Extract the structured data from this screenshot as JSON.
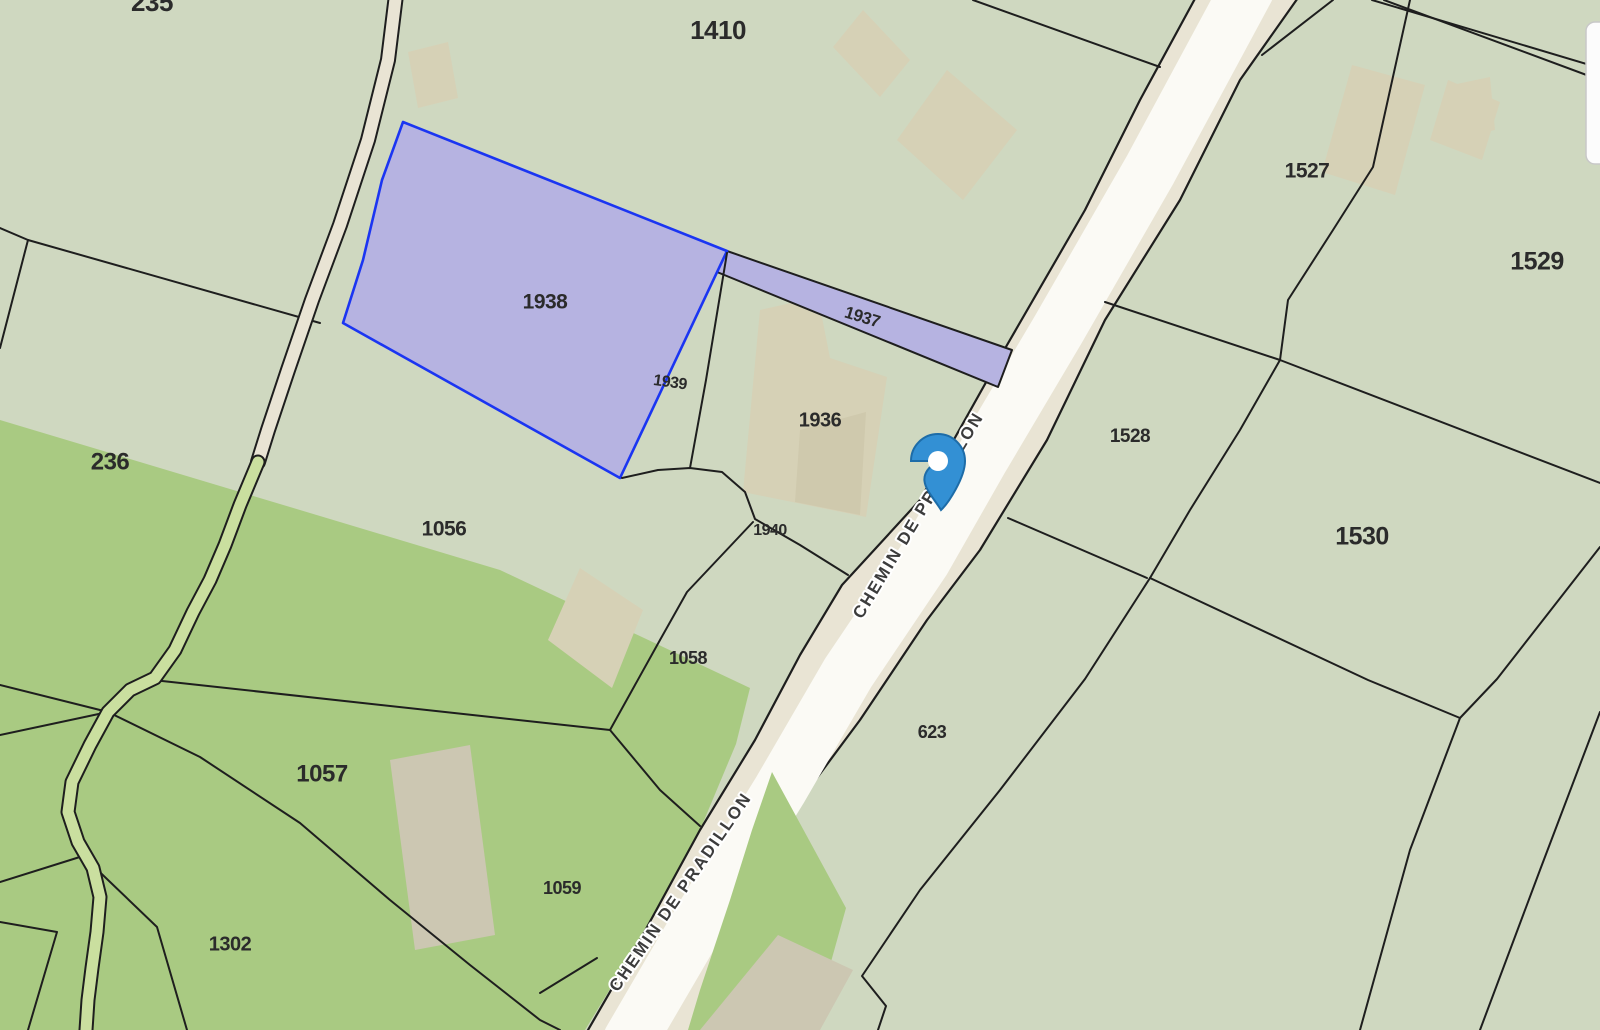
{
  "app": {
    "title": "Cadastral parcel map"
  },
  "map": {
    "width": 1600,
    "height": 1030,
    "colors": {
      "base_green": "#cfd8c0",
      "meadow_green": "#a9ca82",
      "stream_green": "#cadf9f",
      "road_beige": "#e9e4d4",
      "road_core_white": "#fbfaf5",
      "building_beige": "#d6d1b6",
      "building_dark": "#cfc9ad",
      "building_gray": "#ccc7b2",
      "selection_purple": "#b6b3e1",
      "selection_blue": "#1b35f2",
      "boundary_black": "#1e1e1e",
      "label_color": "#2b2b2b",
      "road_label_color": "#3c3c3c",
      "pin_blue": "#3390d4",
      "pin_blue_dark": "#1d6ca8",
      "panel_white": "#fcfcfc"
    },
    "landcover": {
      "meadow_main": "0,420 500,570 750,688 736,744 700,830 640,940 585,1030 0,1030",
      "meadow_road_east": "772,772 846,908 812,1030 688,1030 700,990 730,900 752,830"
    },
    "road": {
      "name": "CHEMIN DE PRADILLON",
      "fill": "1197,-5 1140,100 1085,210 1003,352 920,500 842,585 800,655 755,740 700,830 640,940 588,1030 690,1030 722,955 760,870 802,798 860,720 927,620 980,550 1047,440 1105,320 1180,200 1240,80 1300,-5",
      "left_edge": "1197,-5 1140,100 1085,210 1003,352 920,500 842,585 800,655 755,740 700,830 640,940 588,1030",
      "right_edge": "1300,-5 1240,80 1180,200 1105,320 1047,440 980,550 927,620 860,720 802,798 760,870 722,955 690,1030",
      "core": "1247,-10 1150,170 1058,330 981,460 924,560 848,673 780,790 700,920 630,1040",
      "core_width": 54,
      "labels": [
        {
          "x": 923,
          "y": 518,
          "rot": -59,
          "size": 17
        },
        {
          "x": 685,
          "y": 895,
          "rot": -55.5,
          "size": 17
        }
      ]
    },
    "path_track": {
      "points": "396,-5 388,60 368,140 340,225 312,300 288,370 268,430 258,462"
    },
    "stream": {
      "points": "258,462 240,505 225,545 210,580 193,612 175,650 155,678 130,690 108,712 90,745 72,782 68,812 78,842 93,868 100,897 97,932 92,968 88,1000 86,1030"
    },
    "selected_parcels": [
      {
        "id": "1937",
        "points": "727,251 1012,350 998,387 717,272",
        "outline": "black"
      },
      {
        "id": "1938",
        "points": "403,122 727,251 620,478 343,323 363,260 382,180",
        "outline": "blue"
      }
    ],
    "boundary_lines": [
      {
        "name": "parcel-235-south",
        "points": "0,228 28,240 320,323"
      },
      {
        "name": "parcel-235-west",
        "points": "28,240 0,348"
      },
      {
        "name": "parcel-1410-north",
        "points": "973,0 1160,67"
      },
      {
        "name": "parcel-1939-east",
        "points": "727,253 706,380 690,468"
      },
      {
        "name": "parcel-1940-north",
        "points": "622,478 658,470 690,468 722,472 745,492 755,519 800,545 848,575"
      },
      {
        "name": "parcel-1940-west",
        "points": "753,522 687,592 660,640 610,730"
      },
      {
        "name": "parcel-1056-south",
        "points": "153,680 500,718 610,730"
      },
      {
        "name": "parcel-1059-north",
        "points": "610,730 660,790 700,826"
      },
      {
        "name": "parcel-1302-north",
        "points": "108,712 200,757 300,823 390,900 470,965 540,1020 560,1030"
      },
      {
        "name": "edge-parcel-a",
        "points": "0,685 108,712"
      },
      {
        "name": "edge-parcel-b",
        "points": "0,735 108,712"
      },
      {
        "name": "edge-parcel-c",
        "points": "0,882 83,856"
      },
      {
        "name": "edge-parcel-d",
        "points": "0,922 57,932 28,1030"
      },
      {
        "name": "edge-parcel-e",
        "points": "83,856 157,927 187,1030"
      },
      {
        "name": "parcel-1059-corner",
        "points": "540,993 597,958"
      },
      {
        "name": "parcel-1528-north",
        "points": "1333,0 1262,55"
      },
      {
        "name": "parcel-1527-east",
        "points": "1410,0 1373,167 1333,230 1288,300 1280,360 1240,430 1190,510 1150,578"
      },
      {
        "name": "parcel-623-east",
        "points": "1150,578 1085,679 1000,790 920,890 862,976 886,1006 878,1030"
      },
      {
        "name": "parcel-1530-north",
        "points": "1105,302 1280,360 1600,483"
      },
      {
        "name": "parcel-1528-south",
        "points": "1008,518 1147,578"
      },
      {
        "name": "parcel-1530-west",
        "points": "1150,578 1368,680 1460,718"
      },
      {
        "name": "parcel-1530-east-curve",
        "points": "1600,547 1497,679 1460,718 1410,850 1360,1030"
      },
      {
        "name": "parcel-se-curve",
        "points": "1600,712 1540,870 1480,1030"
      },
      {
        "name": "track-double-line-1",
        "points": "1372,0 1600,68"
      },
      {
        "name": "track-double-line-2",
        "points": "1384,0 1600,80"
      }
    ],
    "buildings": [
      {
        "name": "building-path-small",
        "points": "408,52 448,42 458,98 418,108",
        "tone": "beige"
      },
      {
        "name": "building-1410-small",
        "points": "863,10 910,60 880,97 833,47",
        "tone": "beige"
      },
      {
        "name": "building-1410-large",
        "points": "947,70 1017,130 963,200 897,140",
        "tone": "beige"
      },
      {
        "name": "building-1527-a",
        "points": "1352,65 1425,85 1395,195 1322,172",
        "tone": "beige"
      },
      {
        "name": "building-1527-b",
        "points": "1448,80 1500,102 1482,160 1430,140",
        "tone": "beige"
      },
      {
        "name": "building-ne-corner",
        "points": "1452,85 1490,77 1495,130 1457,138",
        "tone": "beige"
      },
      {
        "name": "building-1936-main",
        "points": "760,310 818,297 830,358 887,377 866,517 743,492 752,395",
        "tone": "beige"
      },
      {
        "name": "building-1936-annex",
        "points": "800,430 866,412 860,515 795,502",
        "tone": "dark"
      },
      {
        "name": "building-1058",
        "points": "580,568 643,610 612,688 548,640",
        "tone": "beige"
      },
      {
        "name": "building-1057",
        "points": "390,760 470,745 495,935 415,950",
        "tone": "gray"
      },
      {
        "name": "building-road-south",
        "points": "778,935 853,970 820,1030 700,1030",
        "tone": "gray"
      }
    ],
    "parcel_labels": [
      {
        "text": "235",
        "x": 152,
        "y": 4,
        "size": 26,
        "rot": 0
      },
      {
        "text": "1410",
        "x": 718,
        "y": 32,
        "size": 26,
        "rot": 0
      },
      {
        "text": "1527",
        "x": 1307,
        "y": 172,
        "size": 21,
        "rot": 0
      },
      {
        "text": "1529",
        "x": 1537,
        "y": 263,
        "size": 25,
        "rot": 0
      },
      {
        "text": "1938",
        "x": 545,
        "y": 303,
        "size": 21,
        "rot": 0
      },
      {
        "text": "1937",
        "x": 862,
        "y": 318,
        "size": 17,
        "rot": 17
      },
      {
        "text": "1939",
        "x": 670,
        "y": 383,
        "size": 16,
        "rot": 8
      },
      {
        "text": "1936",
        "x": 820,
        "y": 421,
        "size": 20,
        "rot": 0
      },
      {
        "text": "1528",
        "x": 1130,
        "y": 437,
        "size": 19,
        "rot": 0
      },
      {
        "text": "1530",
        "x": 1362,
        "y": 538,
        "size": 25,
        "rot": 0
      },
      {
        "text": "236",
        "x": 110,
        "y": 463,
        "size": 24,
        "rot": 0
      },
      {
        "text": "1056",
        "x": 444,
        "y": 530,
        "size": 21,
        "rot": 0
      },
      {
        "text": "1940",
        "x": 770,
        "y": 531,
        "size": 16,
        "rot": 0
      },
      {
        "text": "1058",
        "x": 688,
        "y": 659,
        "size": 18,
        "rot": 0
      },
      {
        "text": "623",
        "x": 932,
        "y": 733,
        "size": 18,
        "rot": 0
      },
      {
        "text": "1057",
        "x": 322,
        "y": 775,
        "size": 24,
        "rot": 0
      },
      {
        "text": "1059",
        "x": 562,
        "y": 889,
        "size": 18,
        "rot": 0
      },
      {
        "text": "1302",
        "x": 230,
        "y": 945,
        "size": 20,
        "rot": 0
      }
    ],
    "marker": {
      "tip_x": 941,
      "tip_y": 510,
      "head_x": 938,
      "head_y": 461,
      "head_r": 27,
      "hole_r": 10
    },
    "side_panel": {
      "x": 1586,
      "y": 22,
      "w": 22,
      "h": 142,
      "rx": 9
    }
  }
}
